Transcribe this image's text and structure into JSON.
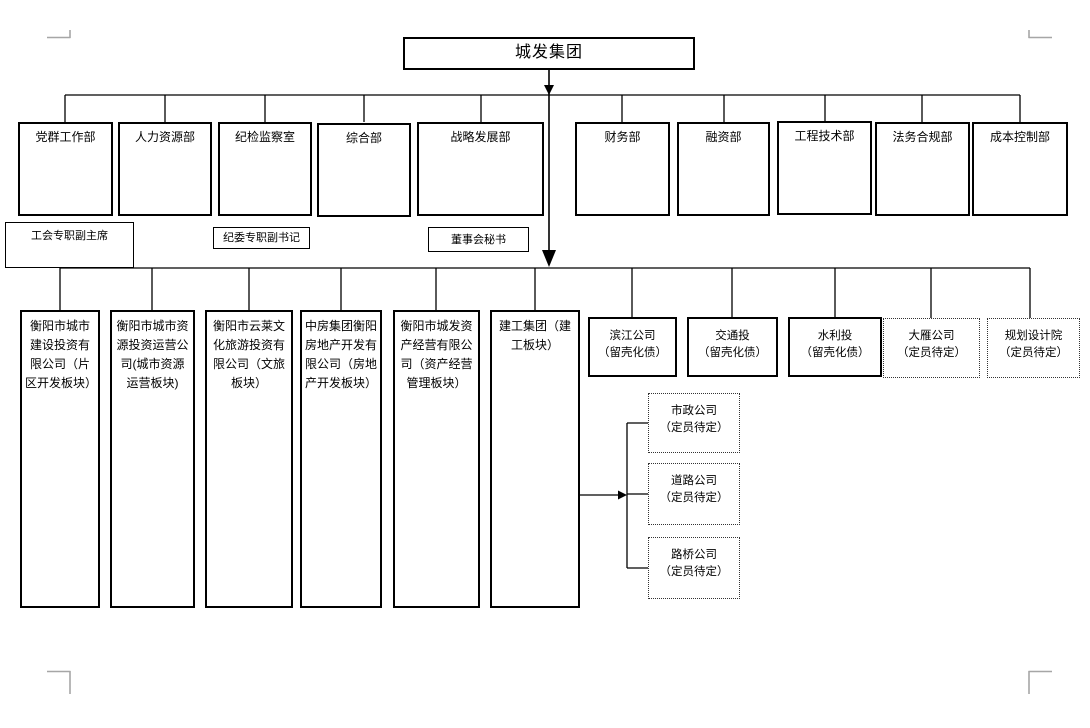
{
  "title": {
    "label": "城发集团"
  },
  "departments": [
    {
      "label": "党群工作部"
    },
    {
      "label": "人力资源部"
    },
    {
      "label": "纪检监察室"
    },
    {
      "label": "综合部"
    },
    {
      "label": "战略发展部"
    },
    {
      "label": "财务部"
    },
    {
      "label": "融资部"
    },
    {
      "label": "工程技术部"
    },
    {
      "label": "法务合规部"
    },
    {
      "label": "成本控制部"
    }
  ],
  "staff_positions": [
    {
      "label": "工会专职副主席"
    },
    {
      "label": "纪委专职副书记"
    },
    {
      "label": "董事会秘书"
    }
  ],
  "subsidiaries": [
    {
      "label": "衡阳市城市建设投资有限公司（片区开发板块）",
      "style": "solid-tall"
    },
    {
      "label": "衡阳市城市资源投资运营公司(城市资源运营板块)",
      "style": "solid-tall"
    },
    {
      "label": "衡阳市云莱文化旅游投资有限公司（文旅板块）",
      "style": "solid-tall"
    },
    {
      "label": "中房集团衡阳房地产开发有限公司（房地产开发板块）",
      "style": "solid-tall"
    },
    {
      "label": "衡阳市城发资产经营有限公司（资产经营管理板块）",
      "style": "solid-tall"
    },
    {
      "label": "建工集团（建工板块）",
      "style": "solid-tall"
    },
    {
      "label": "滨江公司\n（留壳化债）",
      "style": "solid-short"
    },
    {
      "label": "交通投\n（留壳化债）",
      "style": "solid-short"
    },
    {
      "label": "水利投\n（留壳化债）",
      "style": "solid-short"
    },
    {
      "label": "大雁公司\n（定员待定）",
      "style": "dashed-short"
    },
    {
      "label": "规划设计院\n（定员待定）",
      "style": "dashed-short"
    }
  ],
  "construction_branches": [
    {
      "label": "市政公司\n（定员待定）"
    },
    {
      "label": "道路公司\n（定员待定）"
    },
    {
      "label": "路桥公司\n（定员待定）"
    }
  ],
  "colors": {
    "line": "#000000",
    "corner_mark": "#a6a6a6",
    "background": "#ffffff"
  }
}
